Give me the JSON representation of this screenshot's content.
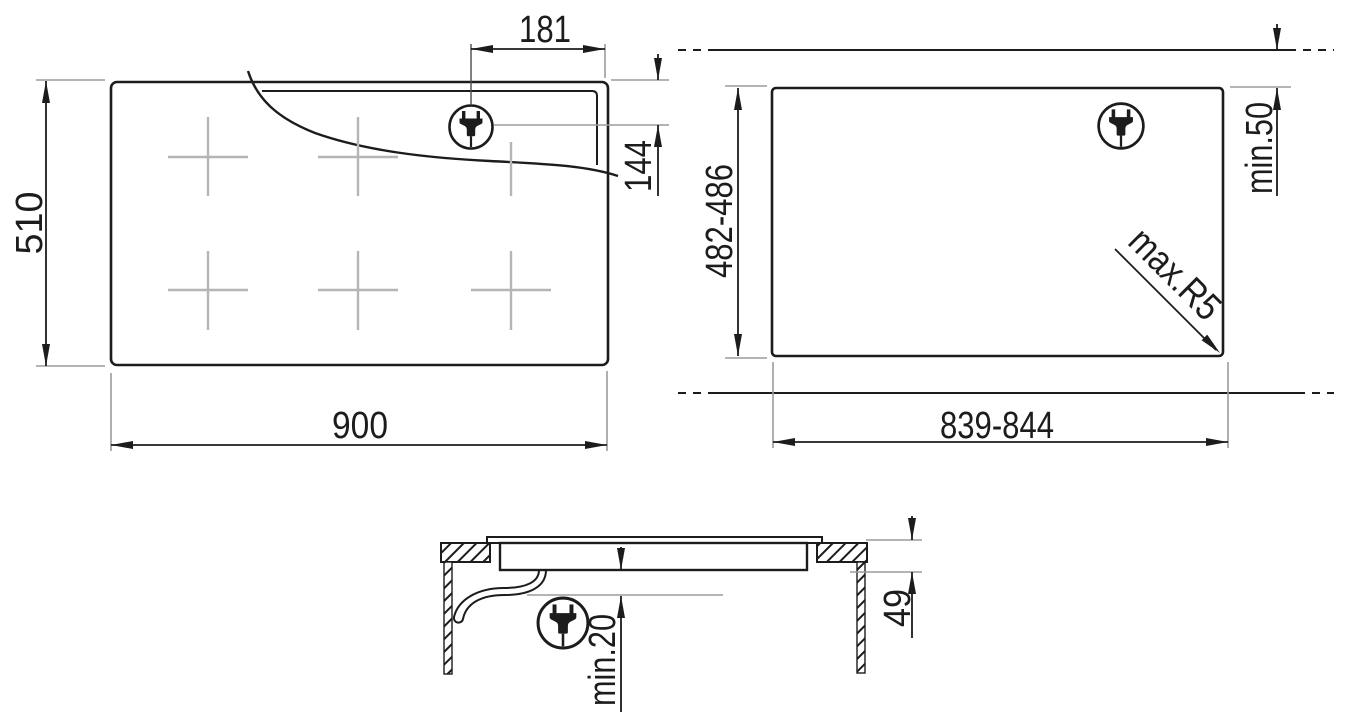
{
  "diagram": {
    "kind": "built-in hob installation drawing",
    "views": {
      "hob_top": {
        "dims": {
          "overall_width": "900",
          "overall_depth": "510",
          "plug_offset_from_right": "181",
          "plug_offset_from_rear": "144"
        }
      },
      "worktop_cutout": {
        "dims": {
          "cutout_width": "839-844",
          "cutout_depth": "482-486",
          "rear_clearance": "min.50",
          "corner_radius": "max.R5"
        }
      },
      "side_section": {
        "dims": {
          "hob_height": "49",
          "clearance_below": "min.20"
        }
      }
    },
    "icons": {
      "plug": "power-plug-icon"
    },
    "colors": {
      "line": "#1c1c1c",
      "extension_line": "#9b9b9b",
      "zone_marker": "#b5b5b5",
      "background": "#ffffff"
    }
  }
}
